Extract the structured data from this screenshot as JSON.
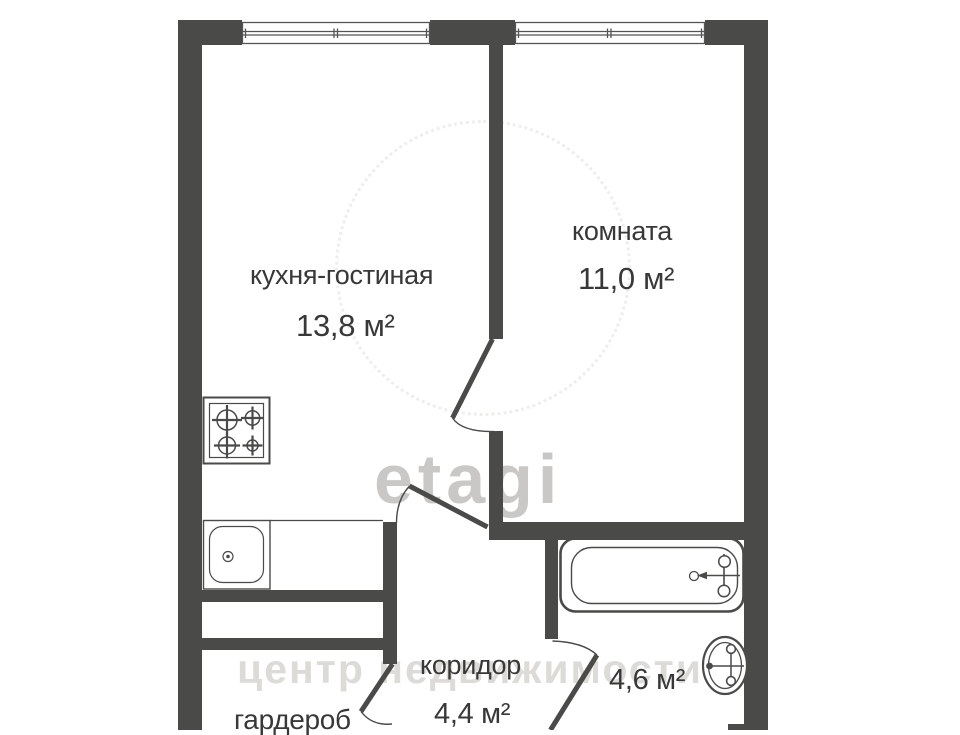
{
  "plan": {
    "type": "apartment-floor-plan",
    "rooms": [
      {
        "id": "kitchen_living",
        "label": "кухня-гостиная",
        "area": "13,8 м²"
      },
      {
        "id": "room",
        "label": "комната",
        "area": "11,0 м²"
      },
      {
        "id": "corridor",
        "label": "коридор",
        "area": "4,4 м²"
      },
      {
        "id": "wardrobe",
        "label": "гардероб"
      },
      {
        "id": "bathroom",
        "area": "4,6 м²"
      }
    ],
    "fixtures": [
      "window-icon",
      "window-icon",
      "stove-icon",
      "sink-icon",
      "bathtub-icon",
      "toilet-icon",
      "door-icon",
      "door-icon",
      "door-icon",
      "door-icon"
    ],
    "watermark": {
      "brand": "etagi",
      "slogan": "центр недвижимости"
    },
    "colors": {
      "wall": "#4a4a48",
      "text": "#383838",
      "background": "#ffffff",
      "watermark_brand": "#b8b6b3",
      "watermark_slogan": "#dcdbd8"
    }
  }
}
